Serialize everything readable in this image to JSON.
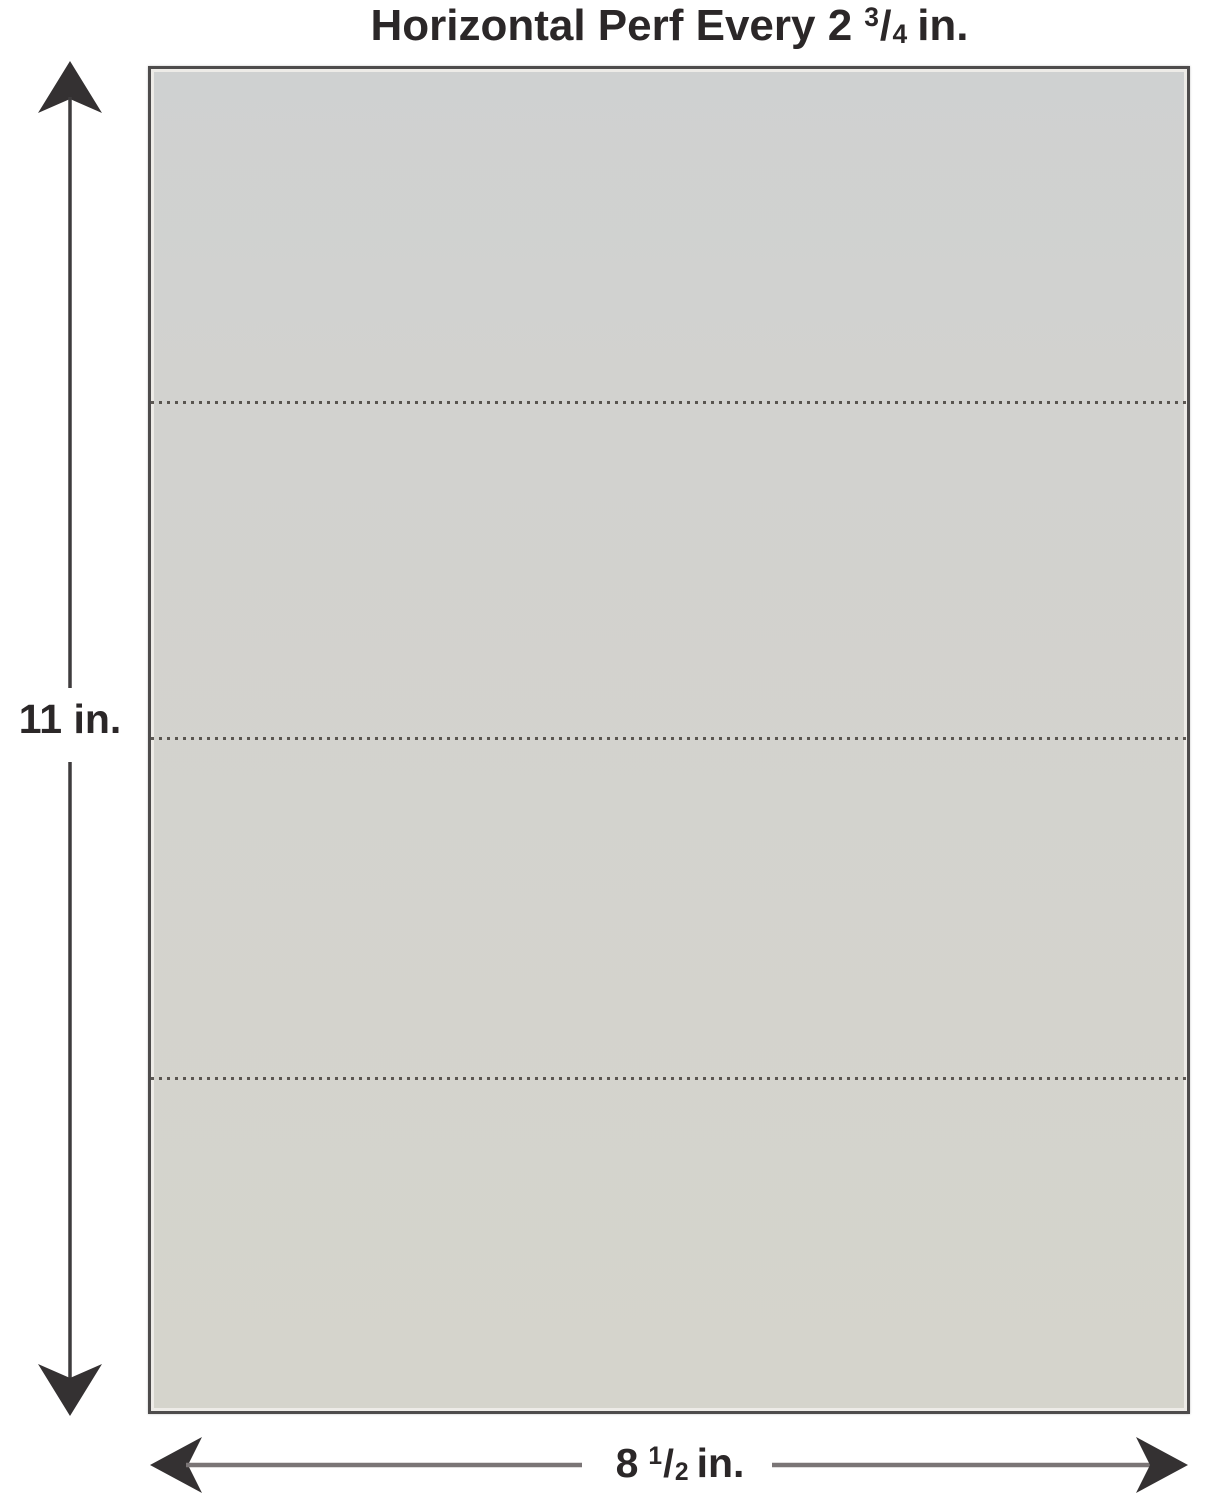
{
  "title": {
    "prefix": "Horizontal Perf Every 2",
    "fraction": {
      "numerator": "3",
      "slash": "/",
      "denominator": "4"
    },
    "suffix": "in."
  },
  "dimensions": {
    "height": {
      "text": "11 in."
    },
    "width": {
      "prefix": "8",
      "fraction": {
        "numerator": "1",
        "slash": "/",
        "denominator": "2"
      },
      "suffix": "in."
    }
  },
  "icons": {
    "vertical_arrow": "double-headed-arrow-vertical",
    "horizontal_arrow": "double-headed-arrow-horizontal"
  },
  "colors": {
    "background": "#ffffff",
    "paper_fill": "#d3d2cc",
    "paper_inner_edge": "#edebe7",
    "paper_border": "#4e4c4c",
    "perforation_dots": "#443f3a",
    "text": "#2b2728",
    "arrowhead_dark": "#343132",
    "vertical_shaft": "#3e3c3d",
    "horizontal_shaft": "#7a7576"
  }
}
